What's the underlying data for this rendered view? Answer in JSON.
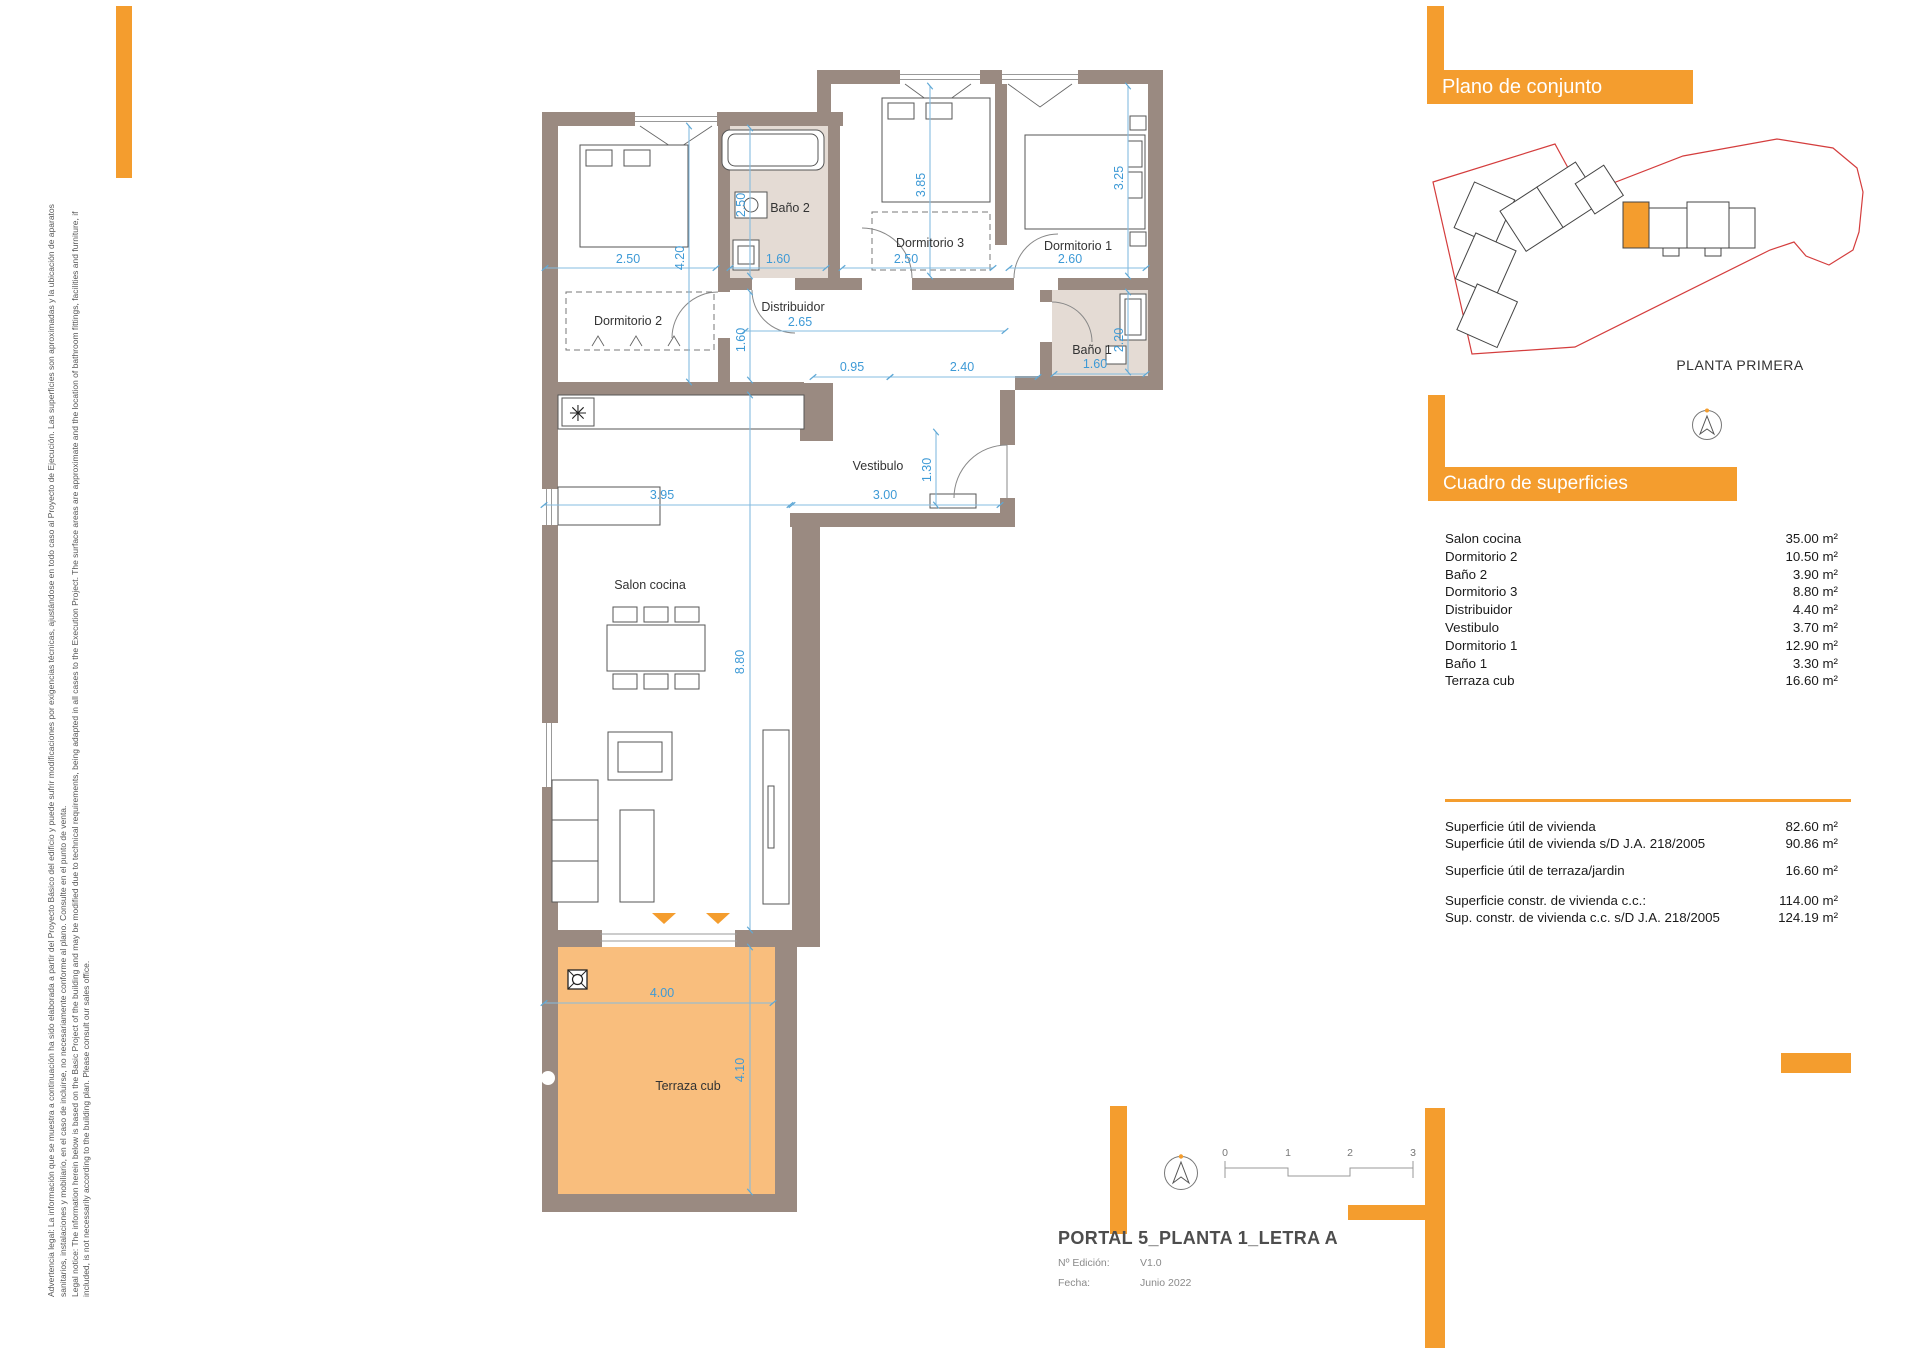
{
  "accent_color": "#F49D2E",
  "terrace_color": "#F9BE7D",
  "wall_color": "#9A8A81",
  "dimension_color": "#3E9AD6",
  "site_boundary_color": "#D43D3D",
  "legal": {
    "lines": [
      "Advertencia legal: La información que se muestra a continuación ha sido elaborada a partir del Proyecto Básico del edificio y puede sufrir modificaciones por exigencias técnicas, ajustándose en todo caso al Proyecto de Ejecución. Las superficies son aproximadas y la ubicación de aparatos",
      "sanitarios, instalaciones y mobiliario, en el caso de incluirse, no necesariamente conforme al plano. Consulte en el punto de venta.",
      "Legal notice: The information herein below is based on the Basic Project of the building and may be modified due to technical requirements, being adapted in all cases to the Execution Project. The surface areas are approximate and the location of bathroom fittings, facilities and furniture, if",
      "included, is not necessarily according to the building plan. Please consult our sales office."
    ]
  },
  "overview": {
    "title": "Plano de conjunto",
    "floor_label": "PLANTA PRIMERA"
  },
  "surfaces": {
    "title": "Cuadro de superficies",
    "rows": [
      {
        "label": "Salon cocina",
        "value": "35.00 m²"
      },
      {
        "label": "Dormitorio 2",
        "value": "10.50 m²"
      },
      {
        "label": "Baño 2",
        "value": "3.90 m²"
      },
      {
        "label": "Dormitorio 3",
        "value": "8.80 m²"
      },
      {
        "label": "Distribuidor",
        "value": "4.40 m²"
      },
      {
        "label": "Vestibulo",
        "value": "3.70 m²"
      },
      {
        "label": "Dormitorio 1",
        "value": "12.90 m²"
      },
      {
        "label": "Baño 1",
        "value": "3.30 m²"
      },
      {
        "label": "Terraza cub",
        "value": "16.60 m²"
      }
    ],
    "totals": [
      {
        "label": "Superficie útil de vivienda",
        "value": "82.60 m²"
      },
      {
        "label": "Superficie útil de vivienda s/D J.A. 218/2005",
        "value": "90.86 m²"
      },
      {
        "label": "Superficie útil de terraza/jardin",
        "value": "16.60 m²"
      },
      {
        "label": "Superficie constr. de vivienda c.c.:",
        "value": "114.00 m²"
      },
      {
        "label": "Sup. constr. de vivienda c.c. s/D J.A. 218/2005",
        "value": "124.19 m²"
      }
    ]
  },
  "plan": {
    "rooms": {
      "dorm2": "Dormitorio 2",
      "bano2": "Baño 2",
      "dorm3": "Dormitorio 3",
      "dorm1": "Dormitorio 1",
      "distribuidor": "Distribuidor",
      "bano1": "Baño 1",
      "vestibulo": "Vestibulo",
      "salon": "Salon cocina",
      "terraza": "Terraza cub"
    },
    "dims": {
      "dorm2_w": "2.50",
      "dorm2_h": "4.20",
      "bano2_h": "2.50",
      "bano2_w": "1.60",
      "dorm3_h": "3.85",
      "dorm3_w": "2.50",
      "dorm1_w": "2.60",
      "dorm1_h": "3.25",
      "distribuidor_w": "2.65",
      "distribuidor_h": "1.60",
      "pasillo1_w": "0.95",
      "pasillo2_w": "2.40",
      "bano1_w": "1.60",
      "bano1_h": "2.20",
      "vestibulo_w": "3.00",
      "vestibulo_door": "1.30",
      "salon_w": "3.95",
      "salon_h": "8.80",
      "terraza_w": "4.00",
      "terraza_h": "4.10"
    },
    "cooktop_icon": "✳"
  },
  "scalebar": {
    "ticks": [
      "0",
      "1",
      "2",
      "3"
    ]
  },
  "titleblock": {
    "title": "PORTAL 5_PLANTA 1_LETRA A",
    "edition_label": "Nº Edición:",
    "edition_value": "V1.0",
    "date_label": "Fecha:",
    "date_value": "Junio 2022"
  }
}
